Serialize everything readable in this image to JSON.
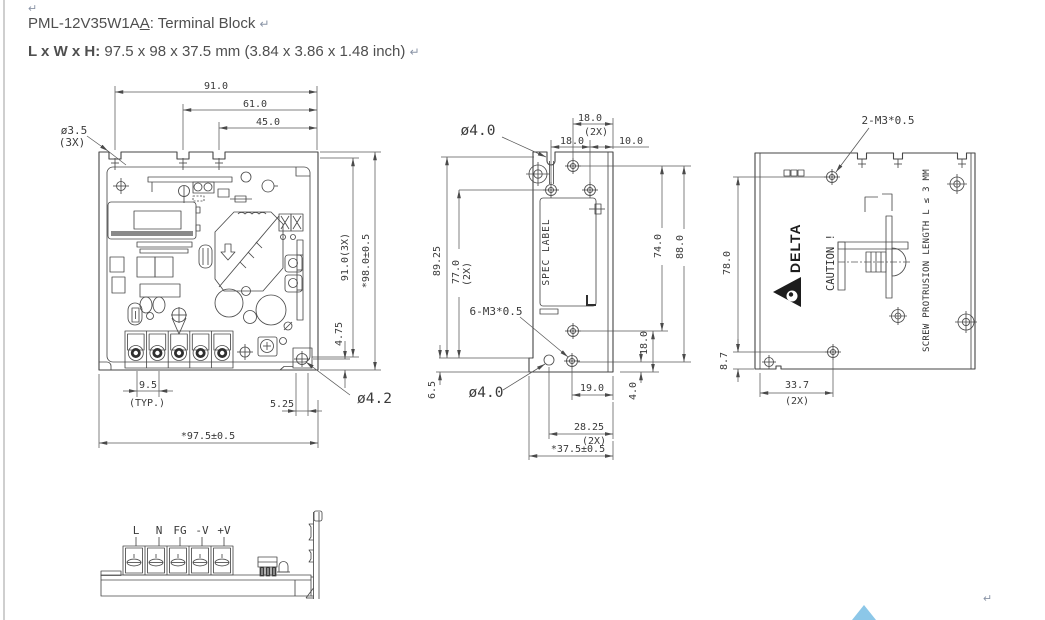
{
  "page": {
    "pilcrow": "↵"
  },
  "header": {
    "model_prefix": "PML-12V35W1A",
    "model_underlined": "A",
    "model_suffix": ": Terminal Block",
    "size_label": "L x W x H:",
    "size_value": " 97.5 x 98 x 37.5 mm (3.84 x 3.86 x 1.48 inch)"
  },
  "top_view": {
    "dim_91": "91.0",
    "dim_61": "61.0",
    "dim_45": "45.0",
    "hole_3_5": "ø3.5",
    "hole_3_5_qty": "(3X)",
    "dim_91_3x": "91.0(3X)",
    "dim_98": "*98.0±0.5",
    "dim_4_75": "4.75",
    "dim_9_5": "9.5",
    "dim_9_5_typ": "(TYP.)",
    "dim_5_25": "5.25",
    "dim_97_5": "*97.5±0.5",
    "hole_4_2": "ø4.2"
  },
  "side_view": {
    "hole_4_0_top": "ø4.0",
    "dim_18_top": "18.0",
    "dim_18_top_qty": "(2X)",
    "dim_18_screws": "18.0",
    "dim_10": "10.0",
    "dim_89_25": "89.25",
    "dim_77": "77.0",
    "dim_77_qty": "(2X)",
    "dim_6_5": "6.5",
    "screw_note": "6-M3*0.5",
    "hole_4_0_bottom": "ø4.0",
    "dim_74": "74.0",
    "dim_88": "88.0",
    "dim_18_right": "18.0",
    "dim_4": "4.0",
    "dim_19": "19.0",
    "dim_28_25": "28.25",
    "dim_28_25_qty": "(2X)",
    "dim_37_5": "*37.5±0.5",
    "spec_label": "SPEC LABEL"
  },
  "back_view": {
    "screw_note": "2-M3*0.5",
    "dim_78": "78.0",
    "dim_8_7": "8.7",
    "dim_33_7": "33.7",
    "dim_33_7_qty": "(2X)",
    "logo_text": "DELTA",
    "caution_text": "CAUTION !",
    "protrusion_note": "SCREW PROTRUSION LENGTH L ≤ 3 MM"
  },
  "terminal_view": {
    "labels": [
      "L",
      "N",
      "FG",
      "-V",
      "+V"
    ]
  }
}
